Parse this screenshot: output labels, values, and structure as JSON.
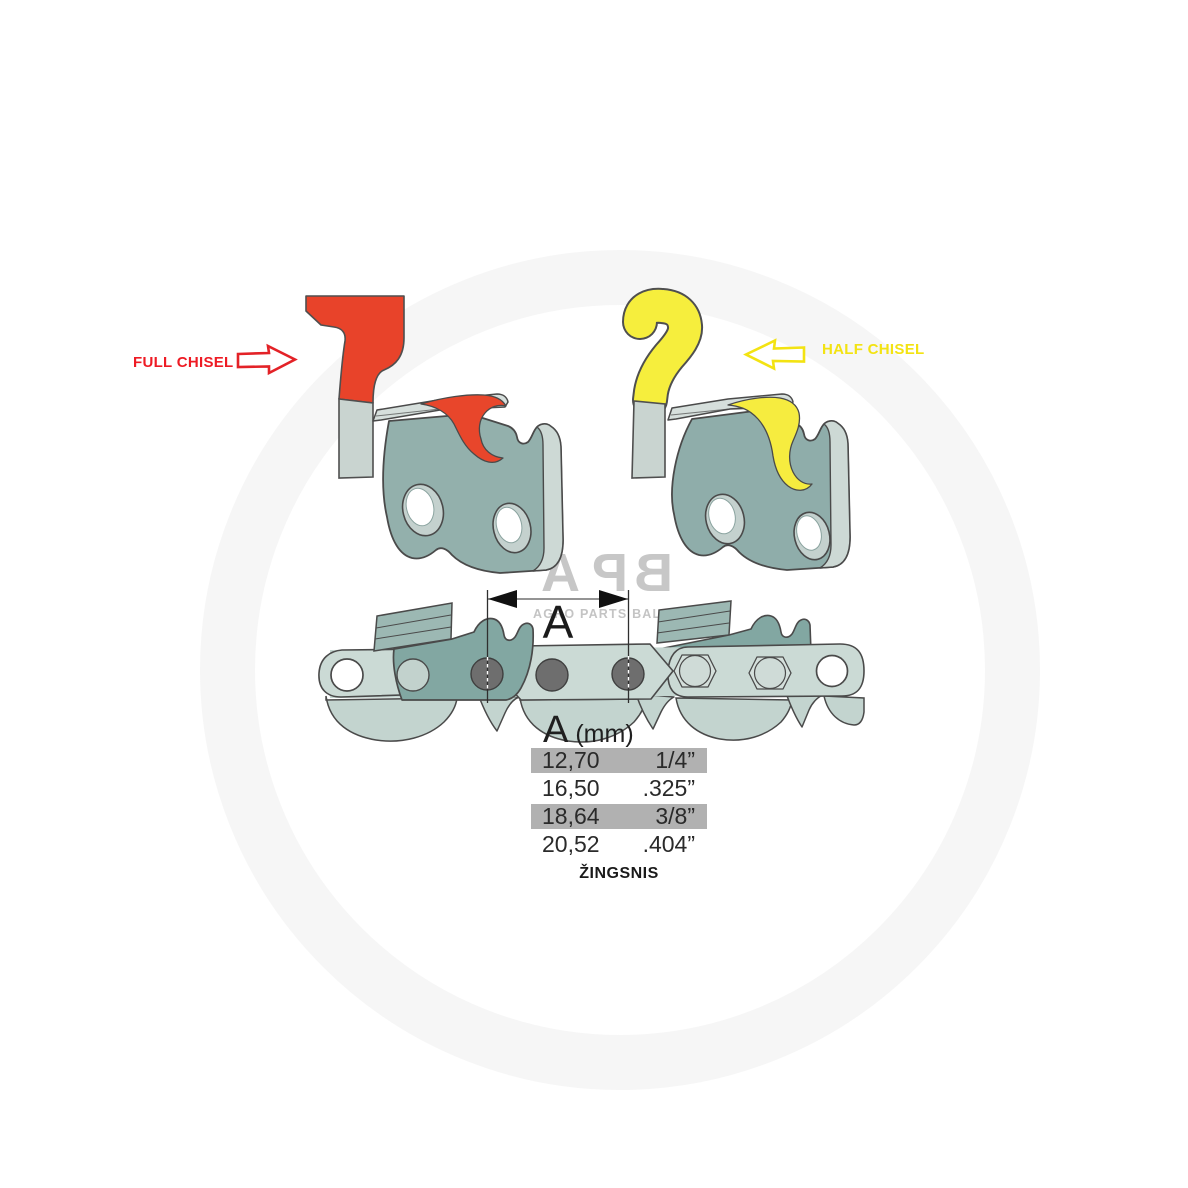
{
  "labels": {
    "full_chisel": "FULL CHISEL",
    "half_chisel": "HALF CHISEL"
  },
  "dimension": {
    "letter": "A"
  },
  "table": {
    "header_letter": "A",
    "header_unit": "(mm)",
    "rows": [
      {
        "mm": "12,70",
        "inch": "1/4”"
      },
      {
        "mm": "16,50",
        "inch": ".325”"
      },
      {
        "mm": "18,64",
        "inch": "3/8”"
      },
      {
        "mm": "20,52",
        "inch": ".404”"
      }
    ],
    "caption": "ŽINGSNIS",
    "highlight_color": "#b1b1b1"
  },
  "watermark": {
    "logo": "APB",
    "letters": [
      "A",
      "P",
      "B"
    ],
    "subtitle": "AGRO PARTS BALTIJA"
  },
  "colors": {
    "full_chisel_accent": "#e8432a",
    "full_chisel_label": "#ee1b24",
    "half_chisel_accent": "#f6ee3d",
    "half_chisel_label": "#f3e312",
    "steel_body": "#93b0ac",
    "steel_light": "#cbdad5",
    "outline": "#4a4a4a",
    "rivet": "#6e6e6e"
  }
}
